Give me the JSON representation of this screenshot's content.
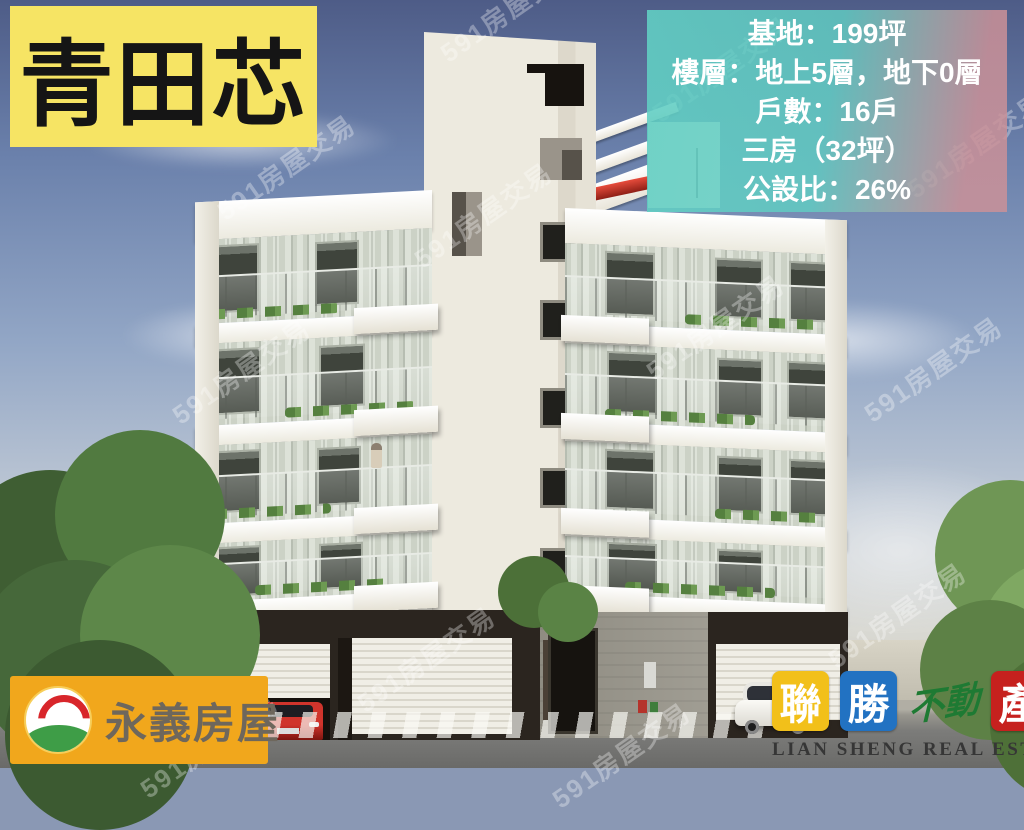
{
  "title_banner": {
    "text": "青田芯",
    "bg_color": "#F6E464",
    "text_color": "#151515"
  },
  "info_box": {
    "lines": [
      "基地：199坪",
      "樓層：地上5層，地下0層",
      "戶數：16戶",
      "三房（32坪）",
      "公設比：26%"
    ],
    "gradient_left_color": "#61CEC3",
    "gradient_right_color": "#CB919B",
    "text_color": "#FFFFFF"
  },
  "watermark": {
    "text": "591房屋交易",
    "color": "rgba(255,255,255,0.32)"
  },
  "yongyi_logo": {
    "brand": "永義房屋",
    "bg_color": "#F1A71C",
    "text_color": "#6E675C",
    "icon": "sun-arch-over-green-hill-circle"
  },
  "liansheng_logo": {
    "tiles": [
      {
        "char": "聯",
        "bg": "#F2C01A",
        "fg": "#FFFFFF"
      },
      {
        "char": "勝",
        "bg": "#2272C2",
        "fg": "#FFFFFF"
      }
    ],
    "script_char": {
      "char": "不動",
      "color": "#1E7A33"
    },
    "red_tile": {
      "char": "產",
      "bg": "#C6211E",
      "fg": "#FFFFFF"
    },
    "english": "LIAN SHENG REAL ESTATE",
    "english_color": "#363636"
  }
}
